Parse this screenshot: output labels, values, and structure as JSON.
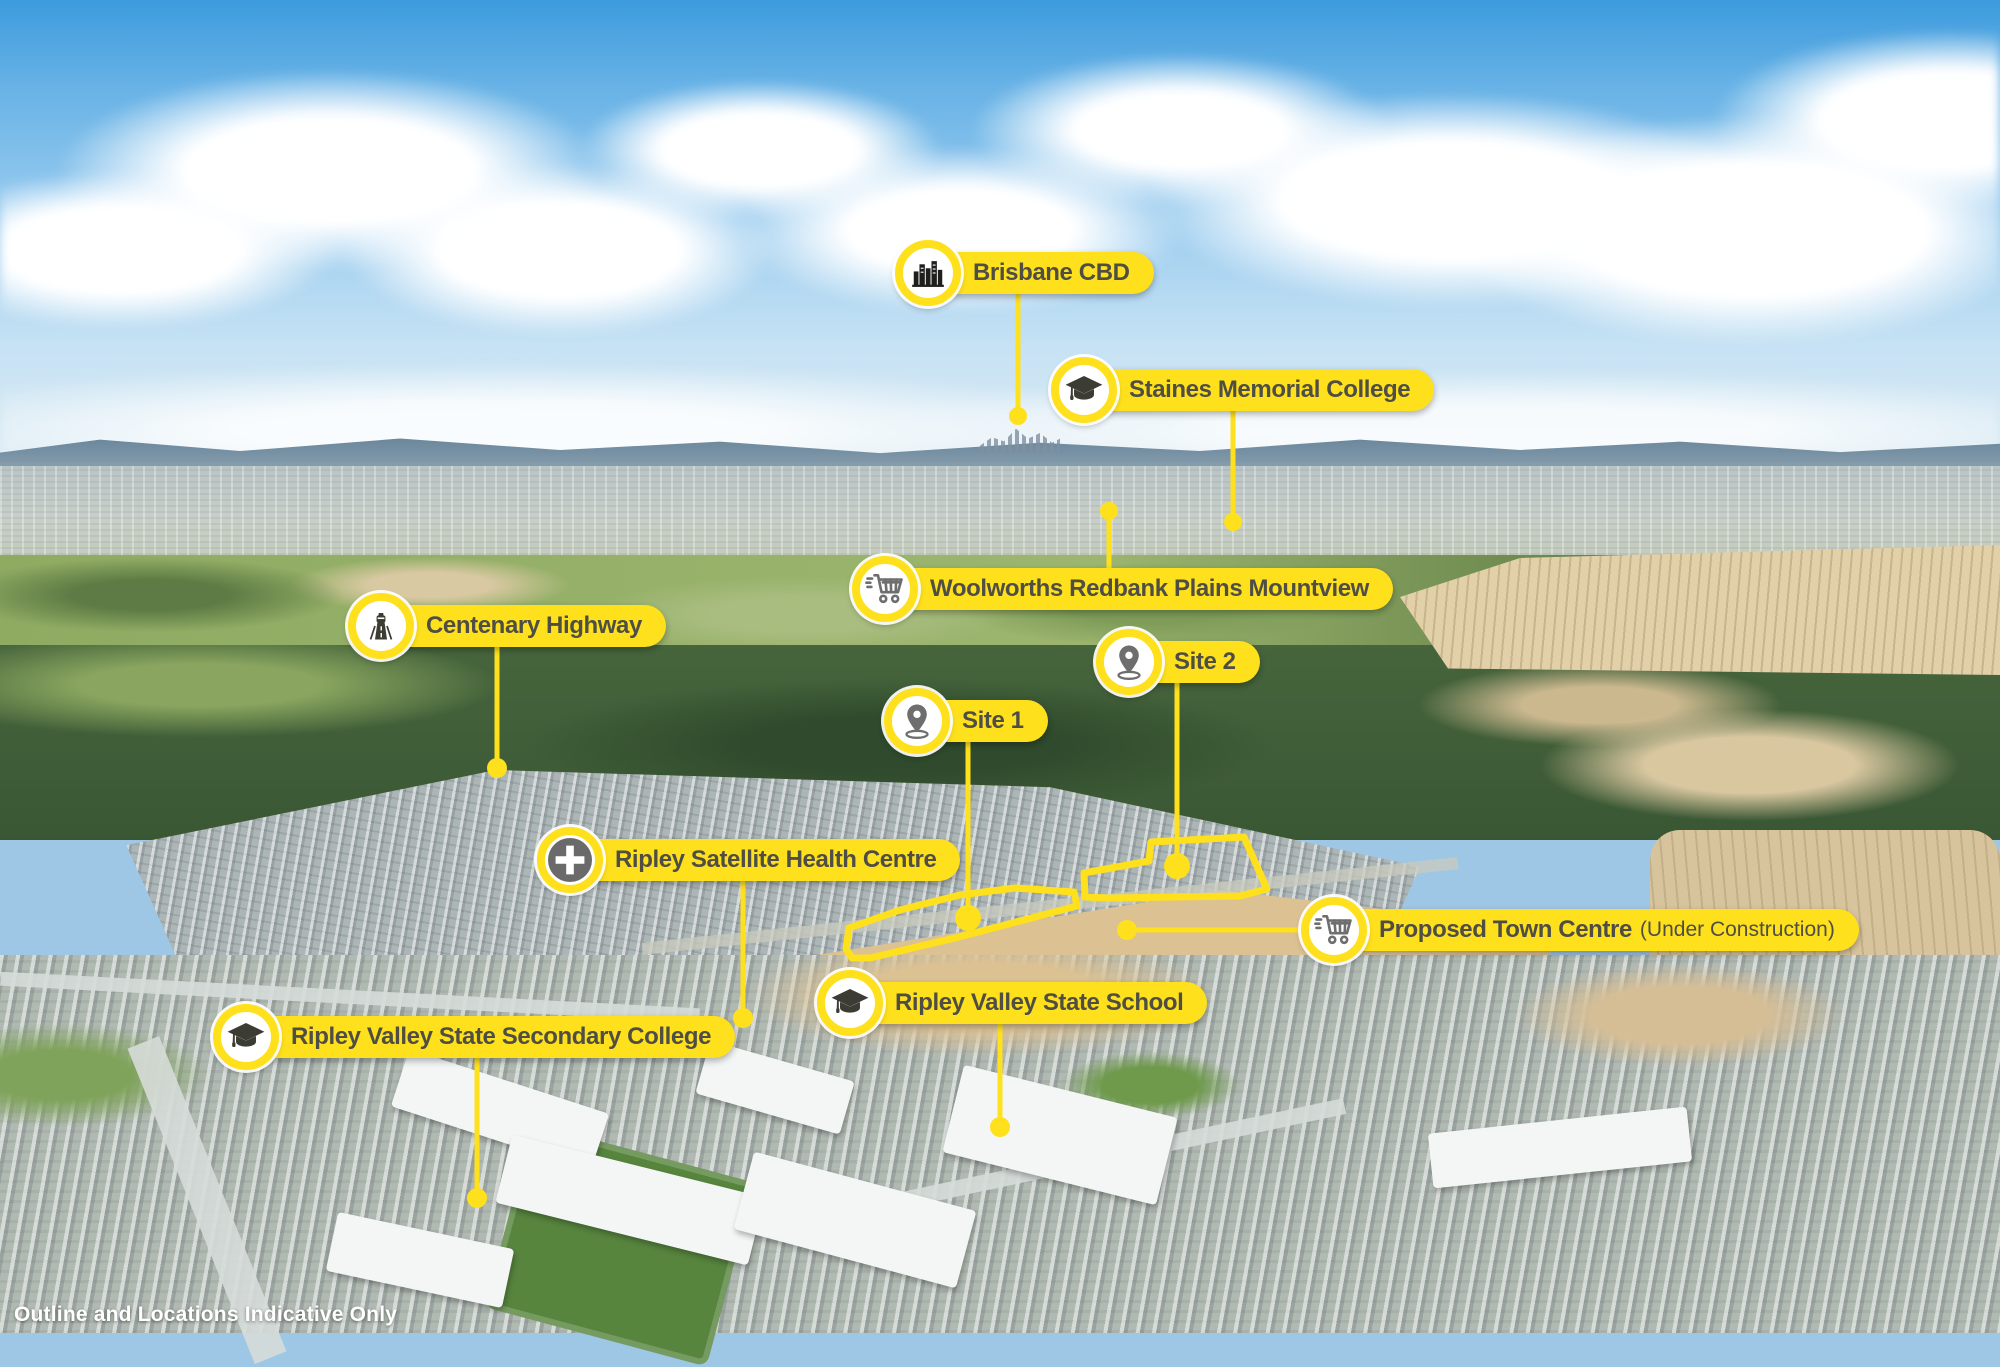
{
  "disclaimer": "Outline and Locations Indicative Only",
  "colors": {
    "accent_yellow": "#FFE01C",
    "label_text": "#4E4E45",
    "icon_gray": "#6E6E6E",
    "icon_dark": "#3C3C35"
  },
  "markers": [
    {
      "id": "brisbane-cbd",
      "label": "Brisbane CBD",
      "sublabel": "",
      "icon": "city-skyline-icon",
      "cx": 928,
      "cy": 273,
      "line": {
        "x1": 1018,
        "y1": 291,
        "x2": 1018,
        "y2": 416
      },
      "dot": {
        "x": 1018,
        "y": 416,
        "r": 9
      }
    },
    {
      "id": "staines-memorial-college",
      "label": "Staines Memorial College",
      "sublabel": "",
      "icon": "graduation-cap-icon",
      "cx": 1084,
      "cy": 390,
      "line": {
        "x1": 1233,
        "y1": 408,
        "x2": 1233,
        "y2": 522
      },
      "dot": {
        "x": 1233,
        "y": 522,
        "r": 9
      }
    },
    {
      "id": "woolworths-redbank-plains-mountview",
      "label": "Woolworths Redbank Plains Mountview",
      "sublabel": "",
      "icon": "shopping-cart-icon",
      "cx": 885,
      "cy": 589,
      "line": {
        "x1": 1109,
        "y1": 571,
        "x2": 1109,
        "y2": 511
      },
      "dot": {
        "x": 1109,
        "y": 511,
        "r": 9
      }
    },
    {
      "id": "centenary-highway",
      "label": "Centenary Highway",
      "sublabel": "",
      "icon": "highway-icon",
      "cx": 381,
      "cy": 626,
      "line": {
        "x1": 497,
        "y1": 644,
        "x2": 497,
        "y2": 768
      },
      "dot": {
        "x": 497,
        "y": 768,
        "r": 10
      }
    },
    {
      "id": "site-2",
      "label": "Site 2",
      "sublabel": "",
      "icon": "map-pin-icon",
      "cx": 1129,
      "cy": 662,
      "line": {
        "x1": 1177,
        "y1": 680,
        "x2": 1177,
        "y2": 866
      },
      "dot": {
        "x": 1177,
        "y": 866,
        "r": 13
      }
    },
    {
      "id": "site-1",
      "label": "Site 1",
      "sublabel": "",
      "icon": "map-pin-icon",
      "cx": 917,
      "cy": 721,
      "line": {
        "x1": 968,
        "y1": 739,
        "x2": 968,
        "y2": 918
      },
      "dot": {
        "x": 968,
        "y": 918,
        "r": 13
      }
    },
    {
      "id": "ripley-satellite-health-centre",
      "label": "Ripley Satellite Health Centre",
      "sublabel": "",
      "icon": "medical-cross-icon",
      "cx": 570,
      "cy": 860,
      "line": {
        "x1": 743,
        "y1": 878,
        "x2": 743,
        "y2": 1018
      },
      "dot": {
        "x": 743,
        "y": 1018,
        "r": 10
      }
    },
    {
      "id": "proposed-town-centre",
      "label": "Proposed Town Centre",
      "sublabel": "(Under Construction)",
      "icon": "shopping-cart-icon",
      "cx": 1334,
      "cy": 930,
      "line": {
        "x1": 1303,
        "y1": 930,
        "x2": 1127,
        "y2": 930
      },
      "dot": {
        "x": 1127,
        "y": 930,
        "r": 10
      }
    },
    {
      "id": "ripley-valley-state-school",
      "label": "Ripley Valley State School",
      "sublabel": "",
      "icon": "graduation-cap-icon",
      "cx": 850,
      "cy": 1003,
      "line": {
        "x1": 1000,
        "y1": 1021,
        "x2": 1000,
        "y2": 1127
      },
      "dot": {
        "x": 1000,
        "y": 1127,
        "r": 10
      }
    },
    {
      "id": "ripley-valley-state-secondary-college",
      "label": "Ripley Valley State Secondary College",
      "sublabel": "",
      "icon": "graduation-cap-icon",
      "cx": 246,
      "cy": 1037,
      "line": {
        "x1": 477,
        "y1": 1055,
        "x2": 477,
        "y2": 1198
      },
      "dot": {
        "x": 477,
        "y": 1198,
        "r": 10
      }
    }
  ],
  "site_outlines": [
    {
      "id": "site-1-outline",
      "points": "846,949 849,928 900,910 960,895 1015,888 1074,892 1077,906 955,938 870,958 852,958"
    },
    {
      "id": "site-2-outline",
      "points": "1085,897 1084,873 1149,861 1151,842 1244,837 1267,889 1240,896 1110,898"
    }
  ]
}
